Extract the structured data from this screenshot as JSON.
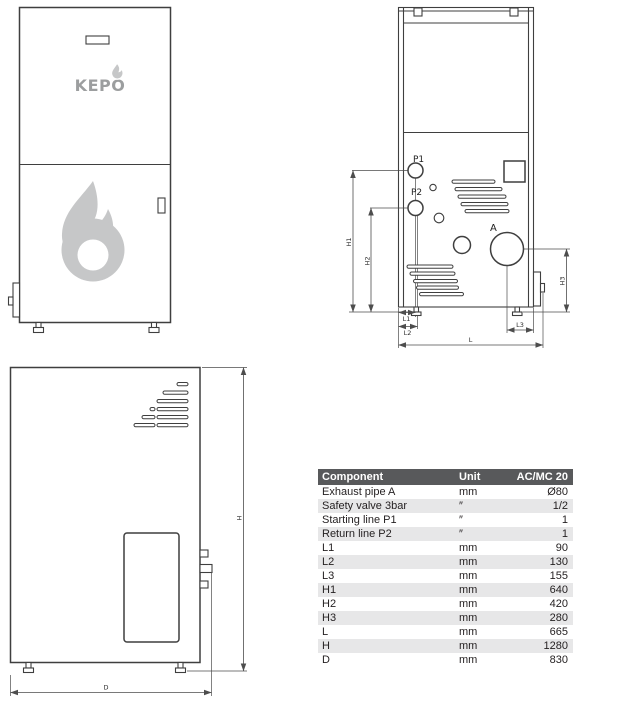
{
  "labels": {
    "brand": "KEPO",
    "p1": "P1",
    "p2": "P2",
    "a": "A",
    "h1": "H1",
    "h2": "H2",
    "h3": "H3",
    "l1": "L1",
    "l2": "L2",
    "l3": "L3",
    "l": "L",
    "h": "H",
    "d": "D"
  },
  "colors": {
    "line": "#3f3f3f",
    "dim": "#4d4d4d",
    "logo_gray": "#c6c7c8",
    "brand_gray": "#9c9e9f",
    "table_header_bg": "#58595b",
    "table_header_text": "#ffffff",
    "row_alt_bg": "#e7e7e8",
    "text": "#231f20"
  },
  "table": {
    "headers": [
      "Component",
      "Unit",
      "AC/MC 20"
    ],
    "rows": [
      {
        "component": "Exhaust pipe A",
        "unit": "mm",
        "value": "Ø80"
      },
      {
        "component": "Safety valve 3bar",
        "unit": "″",
        "value": "1/2"
      },
      {
        "component": "Starting line P1",
        "unit": "″",
        "value": "1"
      },
      {
        "component": "Return line  P2",
        "unit": "″",
        "value": "1"
      },
      {
        "component": "L1",
        "unit": "mm",
        "value": "90"
      },
      {
        "component": "L2",
        "unit": "mm",
        "value": "130"
      },
      {
        "component": "L3",
        "unit": "mm",
        "value": "155"
      },
      {
        "component": "H1",
        "unit": "mm",
        "value": "640"
      },
      {
        "component": "H2",
        "unit": "mm",
        "value": "420"
      },
      {
        "component": "H3",
        "unit": "mm",
        "value": "280"
      },
      {
        "component": "L",
        "unit": "mm",
        "value": "665"
      },
      {
        "component": "H",
        "unit": "mm",
        "value": "1280"
      },
      {
        "component": "D",
        "unit": "mm",
        "value": "830"
      }
    ]
  }
}
